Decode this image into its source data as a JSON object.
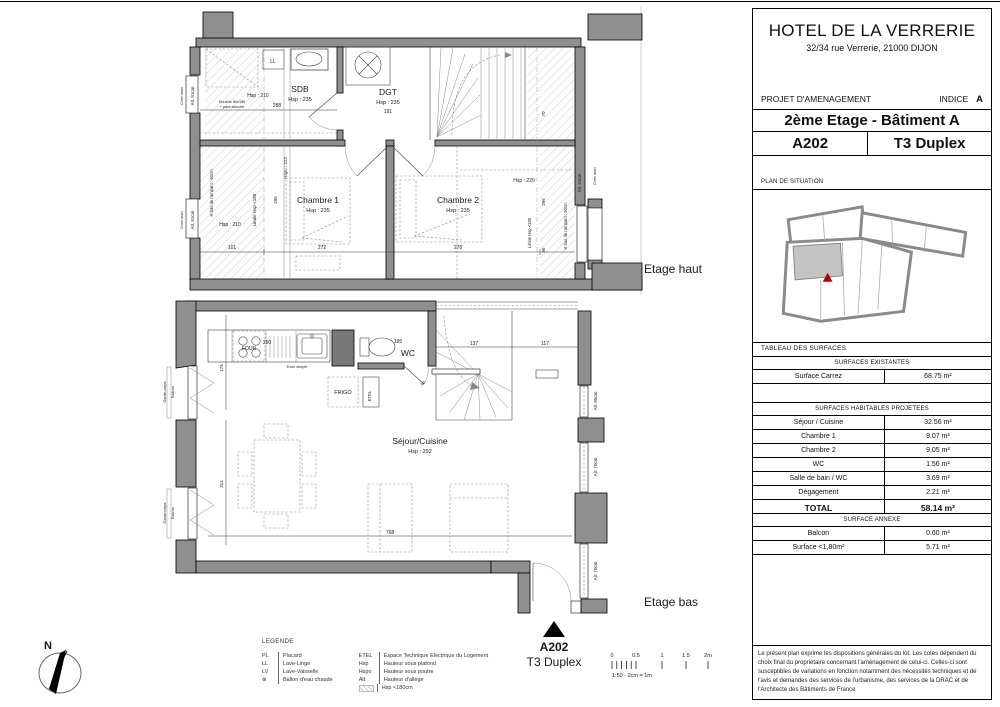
{
  "title_block": {
    "hotel_name": "HOTEL DE LA VERRERIE",
    "address": "32/34 rue Verrerie, 21000 DIJON",
    "project_label": "PROJET D'AMENAGEMENT",
    "indice_label": "INDICE",
    "indice_value": "A",
    "floor_title": "2ème Etage - Bâtiment A",
    "unit_number": "A202",
    "unit_type": "T3 Duplex",
    "situation_label": "PLAN DE SITUATION",
    "disclaimer": "Le présent plan exprime les dispositions générales du lot. Les cotes dépendent du choix final du propriétaire concernant l'aménagement de celui-ci. Celles-ci sont susceptibles de variations en fonction notamment des nécessités techniques et de l'avis et demandes des services de l'urbanisme, des services de la DRAC et de l'Architecte des Bâtiments de France"
  },
  "surfaces": {
    "table_title": "TABLEAU DES SURFACES",
    "existing_header": "SURFACES EXISTANTES",
    "existing_rows": [
      {
        "label": "Surface Carrez",
        "value": "68.75 m²"
      }
    ],
    "projected_header": "SURFACES HABITABLES PROJETEES",
    "projected_rows": [
      {
        "label": "Séjour / Cuisine",
        "value": "32.56 m²"
      },
      {
        "label": "Chambre 1",
        "value": "9.07 m²"
      },
      {
        "label": "Chambre 2",
        "value": "9.05 m²"
      },
      {
        "label": "WC",
        "value": "1.56 m²"
      },
      {
        "label": "Salle de bain / WC",
        "value": "3.69 m²"
      },
      {
        "label": "Dégagement",
        "value": "2.21 m²"
      }
    ],
    "total_label": "TOTAL",
    "total_value": "58.14 m²",
    "annex_header": "SURFACE ANNEXE",
    "annex_rows": [
      {
        "label": "Balcon",
        "value": "0.60 m²"
      },
      {
        "label": "Surface <1,80m²",
        "value": "5.71 m²"
      }
    ]
  },
  "legend": {
    "title": "LEGENDE",
    "col1": [
      {
        "abbr": "PL",
        "label": "Placard"
      },
      {
        "abbr": "LL",
        "label": "Lave-Linge"
      },
      {
        "abbr": "LV",
        "label": "Lave-Vaisselle"
      },
      {
        "abbr": "⊗",
        "label": "Ballon d'eau chaude"
      }
    ],
    "col2": [
      {
        "abbr": "ETEL",
        "label": "Espace Technique Electrique du Logement"
      },
      {
        "abbr": "Hsp",
        "label": "Hauteur sous plafond"
      },
      {
        "abbr": "Hspo",
        "label": "Hauteur sous poutre"
      },
      {
        "abbr": "Alt",
        "label": "Hauteur d'allège"
      },
      {
        "abbr": "hatch-swatch",
        "label": "Hsp <180cm"
      }
    ]
  },
  "plan_labels": [
    {
      "t": "SDB",
      "x": 300,
      "y": 92,
      "s": 8.5
    },
    {
      "t": "Hsp : 235",
      "x": 300,
      "y": 101,
      "s": 5.5
    },
    {
      "t": "Hsp : 210",
      "x": 258,
      "y": 97,
      "s": 5
    },
    {
      "t": "288",
      "x": 277,
      "y": 107,
      "s": 5
    },
    {
      "t": "LL",
      "x": 273,
      "y": 63,
      "s": 5
    },
    {
      "t": "Douche 80x180",
      "x": 232,
      "y": 103,
      "s": 3.8
    },
    {
      "t": "+ pare-douche",
      "x": 232,
      "y": 108,
      "s": 3.8
    },
    {
      "t": "DGT",
      "x": 388,
      "y": 95,
      "s": 8.5
    },
    {
      "t": "Hsp : 235",
      "x": 388,
      "y": 104,
      "s": 5.5
    },
    {
      "t": "191",
      "x": 388,
      "y": 113,
      "s": 5
    },
    {
      "t": "Chambre 1",
      "x": 318,
      "y": 203,
      "s": 8.5
    },
    {
      "t": "Hsp : 235",
      "x": 318,
      "y": 212,
      "s": 5.5
    },
    {
      "t": "272",
      "x": 322,
      "y": 249,
      "s": 5
    },
    {
      "t": "101",
      "x": 232,
      "y": 249,
      "s": 5
    },
    {
      "t": "Hsp : 210",
      "x": 230,
      "y": 226,
      "s": 5
    },
    {
      "t": "Limite Hsp <180",
      "x": 256,
      "y": 210,
      "s": 4.5,
      "r": -90
    },
    {
      "t": "Hspo : 223",
      "x": 287,
      "y": 168,
      "s": 4.5,
      "r": -90
    },
    {
      "t": "296",
      "x": 277,
      "y": 200,
      "s": 4.5,
      "r": -90
    },
    {
      "t": "H bas de rampant : 90cm",
      "x": 213,
      "y": 193,
      "s": 4.2,
      "r": -90
    },
    {
      "t": "Alt. 91cm",
      "x": 194,
      "y": 96,
      "s": 4.5,
      "r": -90
    },
    {
      "t": "Chien assis",
      "x": 183,
      "y": 96,
      "s": 3.4,
      "r": -90
    },
    {
      "t": "Alt. 91cm",
      "x": 194,
      "y": 220,
      "s": 4.5,
      "r": -90
    },
    {
      "t": "Chien assis",
      "x": 183,
      "y": 220,
      "s": 3.4,
      "r": -90
    },
    {
      "t": "Chambre 2",
      "x": 458,
      "y": 203,
      "s": 8.5
    },
    {
      "t": "Hsp : 235",
      "x": 458,
      "y": 212,
      "s": 5.5
    },
    {
      "t": "278",
      "x": 458,
      "y": 249,
      "s": 5
    },
    {
      "t": "Hsp : 220",
      "x": 524,
      "y": 182,
      "s": 5
    },
    {
      "t": "296",
      "x": 545,
      "y": 202,
      "s": 4.5,
      "r": -90
    },
    {
      "t": "70",
      "x": 545,
      "y": 114,
      "s": 4.5,
      "r": -90
    },
    {
      "t": "Limite Hsp <180",
      "x": 531,
      "y": 233,
      "s": 4.2,
      "r": -90
    },
    {
      "t": "H bas de rampant : 90cm",
      "x": 567,
      "y": 226,
      "s": 4.2,
      "r": -90
    },
    {
      "t": "Alt. 91cm",
      "x": 581,
      "y": 183,
      "s": 4.5,
      "r": -90
    },
    {
      "t": "Chien assis",
      "x": 596,
      "y": 176,
      "s": 3.4,
      "r": -90
    },
    {
      "t": "96",
      "x": 545,
      "y": 250,
      "s": 4.5,
      "r": -90
    },
    {
      "t": "FOUR",
      "x": 249,
      "y": 350,
      "s": 5
    },
    {
      "t": "250",
      "x": 267,
      "y": 344,
      "s": 5
    },
    {
      "t": "Evier simple",
      "x": 297,
      "y": 368,
      "s": 3.8
    },
    {
      "t": "174",
      "x": 223,
      "y": 368,
      "s": 4.5,
      "r": -90
    },
    {
      "t": "195",
      "x": 398,
      "y": 343,
      "s": 5
    },
    {
      "t": "WC",
      "x": 408,
      "y": 356,
      "s": 8.5
    },
    {
      "t": "FRIGO",
      "x": 343,
      "y": 394,
      "s": 5.5
    },
    {
      "t": "ETEL",
      "x": 371,
      "y": 396,
      "s": 4.2,
      "r": -90
    },
    {
      "t": "137",
      "x": 474,
      "y": 345,
      "s": 5
    },
    {
      "t": "117",
      "x": 545,
      "y": 345,
      "s": 5
    },
    {
      "t": "Séjour/Cuisine",
      "x": 420,
      "y": 444,
      "s": 8.5
    },
    {
      "t": "Hsp : 292",
      "x": 420,
      "y": 453,
      "s": 5.5
    },
    {
      "t": "768",
      "x": 390,
      "y": 534,
      "s": 5
    },
    {
      "t": "314",
      "x": 223,
      "y": 484,
      "s": 4.5,
      "r": -90
    },
    {
      "t": "Garde-corps",
      "x": 166,
      "y": 392,
      "s": 3.8,
      "r": -90
    },
    {
      "t": "Balcon",
      "x": 174,
      "y": 392,
      "s": 3.8,
      "r": -90
    },
    {
      "t": "Garde-corps",
      "x": 166,
      "y": 513,
      "s": 3.8,
      "r": -90
    },
    {
      "t": "Balcon",
      "x": 174,
      "y": 513,
      "s": 3.8,
      "r": -90
    },
    {
      "t": "Alt. 85cm",
      "x": 597,
      "y": 401,
      "s": 4.5,
      "r": -90
    },
    {
      "t": "Alt. 70cm",
      "x": 597,
      "y": 467,
      "s": 4.5,
      "r": -90
    },
    {
      "t": "Alt. 70cm",
      "x": 597,
      "y": 571,
      "s": 4.5,
      "r": -90
    },
    {
      "t": "60",
      "x": 424,
      "y": 384,
      "s": 4,
      "r": -50
    },
    {
      "n": "caption-etage-haut",
      "t": "Etage haut",
      "x": 673,
      "y": 273,
      "s": 12
    },
    {
      "n": "caption-etage-bas",
      "t": "Etage bas",
      "x": 671,
      "y": 606,
      "s": 12
    },
    {
      "n": "unit-marker-number",
      "t": "A202",
      "x": 554,
      "y": 651,
      "s": 12,
      "b": true
    },
    {
      "n": "unit-marker-type",
      "t": "T3 Duplex",
      "x": 554,
      "y": 666,
      "s": 12
    },
    {
      "n": "compass-north-label",
      "t": "N",
      "x": 48,
      "y": 649,
      "s": 11,
      "b": true
    },
    {
      "n": "scale-tick-label",
      "t": "0",
      "x": 612,
      "y": 657,
      "s": 5.5
    },
    {
      "n": "scale-tick-label",
      "t": "0.5",
      "x": 636,
      "y": 657,
      "s": 5.5
    },
    {
      "n": "scale-tick-label",
      "t": "1",
      "x": 662,
      "y": 657,
      "s": 5.5
    },
    {
      "n": "scale-tick-label",
      "t": "1.5",
      "x": 686,
      "y": 657,
      "s": 5.5
    },
    {
      "n": "scale-tick-label",
      "t": "2m",
      "x": 708,
      "y": 657,
      "s": 5.5
    },
    {
      "n": "scale-note",
      "t": "1:50 - 2cm = 1m",
      "x": 612,
      "y": 677,
      "s": 5.5,
      "a": "start"
    }
  ]
}
